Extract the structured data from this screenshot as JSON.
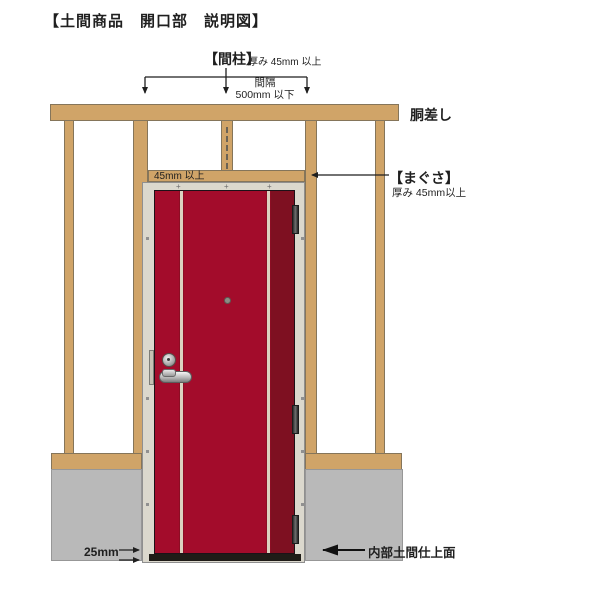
{
  "title": "【土間商品　開口部　説明図】",
  "annotations": {
    "mabashira": {
      "name": "【間柱】",
      "spec": "厚み 45mm 以上"
    },
    "spacing": {
      "line1": "間隔",
      "line2": "500mm 以下"
    },
    "dousashi": "胴差し",
    "lintel_thickness": "45mm 以上",
    "magusa": {
      "name": "【まぐさ】",
      "spec": "厚み 45mm以上"
    },
    "bottom_gap": "25mm",
    "interior_floor": "内部土間仕上面"
  },
  "colors": {
    "wood": "#d0a468",
    "wood_border": "#85755a",
    "concrete": "#b9b9b9",
    "door_frame": "#dbd8cd",
    "door_red": "#a30c2b",
    "door_red_dark": "#7e1021",
    "door_stripe": "#dcd2c0",
    "annotation_line": "#1f1f1f"
  }
}
